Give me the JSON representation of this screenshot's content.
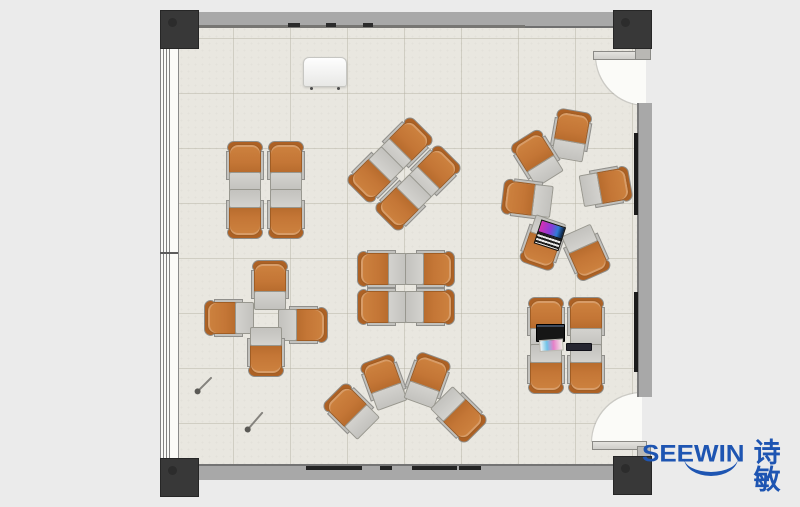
{
  "brand": {
    "name": "SEEWIN",
    "cjk": "诗敏",
    "color": "#1e55b2"
  },
  "palette": {
    "outside": "#ebebeb",
    "floor": "#e9e7e0",
    "wall": "#a8a8a8",
    "post": "#383838",
    "chair_seat": "#c47636",
    "chair_tablet": "#c9c8c4",
    "wall_board": "#1b1b1b",
    "brand_blue": "#1e55b2"
  },
  "floor_plan": {
    "chairs": [
      {
        "cluster": "quad-front-left",
        "x": 245,
        "y": 166,
        "rot": 0
      },
      {
        "cluster": "quad-front-left",
        "x": 286,
        "y": 166,
        "rot": 0
      },
      {
        "cluster": "quad-front-left",
        "x": 245,
        "y": 214,
        "rot": 180
      },
      {
        "cluster": "quad-front-left",
        "x": 286,
        "y": 214,
        "rot": 180
      },
      {
        "cluster": "quad-rotated-center",
        "x": 405,
        "y": 145,
        "rot": 45
      },
      {
        "cluster": "quad-rotated-center",
        "x": 433,
        "y": 173,
        "rot": 45
      },
      {
        "cluster": "quad-rotated-center",
        "x": 375,
        "y": 175,
        "rot": 225
      },
      {
        "cluster": "quad-rotated-center",
        "x": 403,
        "y": 203,
        "rot": 225
      },
      {
        "cluster": "circle-right",
        "x": 571,
        "y": 135,
        "rot": 10
      },
      {
        "cluster": "circle-right",
        "x": 537,
        "y": 158,
        "rot": 328
      },
      {
        "cluster": "circle-right",
        "x": 527,
        "y": 199,
        "rot": 277
      },
      {
        "cluster": "circle-right",
        "x": 543,
        "y": 243,
        "rot": 199
      },
      {
        "cluster": "circle-right",
        "x": 586,
        "y": 253,
        "rot": 156
      },
      {
        "cluster": "circle-right",
        "x": 606,
        "y": 187,
        "rot": 80
      },
      {
        "cluster": "quad-center",
        "x": 382,
        "y": 269,
        "rot": 270
      },
      {
        "cluster": "quad-center",
        "x": 382,
        "y": 307,
        "rot": 270
      },
      {
        "cluster": "quad-center",
        "x": 430,
        "y": 269,
        "rot": 90
      },
      {
        "cluster": "quad-center",
        "x": 430,
        "y": 307,
        "rot": 90
      },
      {
        "cluster": "cross-left",
        "x": 270,
        "y": 285,
        "rot": 0
      },
      {
        "cluster": "cross-left",
        "x": 229,
        "y": 318,
        "rot": 270
      },
      {
        "cluster": "cross-left",
        "x": 303,
        "y": 325,
        "rot": 90
      },
      {
        "cluster": "cross-left",
        "x": 266,
        "y": 352,
        "rot": 180
      },
      {
        "cluster": "arc-bottom",
        "x": 351,
        "y": 411,
        "rot": 315
      },
      {
        "cluster": "arc-bottom",
        "x": 384,
        "y": 382,
        "rot": 340
      },
      {
        "cluster": "arc-bottom",
        "x": 427,
        "y": 380,
        "rot": 20
      },
      {
        "cluster": "arc-bottom",
        "x": 459,
        "y": 415,
        "rot": 135
      },
      {
        "cluster": "quad-right",
        "x": 546,
        "y": 322,
        "rot": 0
      },
      {
        "cluster": "quad-right",
        "x": 586,
        "y": 322,
        "rot": 0
      },
      {
        "cluster": "quad-right",
        "x": 546,
        "y": 369,
        "rot": 180
      },
      {
        "cluster": "quad-right",
        "x": 586,
        "y": 369,
        "rot": 180
      }
    ],
    "items": [
      {
        "type": "podium",
        "name": "podium",
        "x": 303,
        "y": 57,
        "w": 42,
        "h": 28,
        "rot": 0
      },
      {
        "type": "laptop-color",
        "name": "open-laptop",
        "x": 541,
        "y": 220,
        "w": 24,
        "h": 25,
        "rot": 18
      },
      {
        "type": "laptop-black",
        "name": "closed-laptop",
        "x": 536,
        "y": 324,
        "w": 27,
        "h": 16,
        "rot": 0
      },
      {
        "type": "paper",
        "name": "color-print",
        "x": 539,
        "y": 340,
        "w": 22,
        "h": 10,
        "rot": -4
      },
      {
        "type": "notebook",
        "name": "notebook",
        "x": 566,
        "y": 343,
        "w": 24,
        "h": 6,
        "rot": 0
      },
      {
        "type": "pin",
        "name": "floor-pin",
        "x": 197,
        "y": 389,
        "w": 20,
        "h": 2,
        "rot": -45
      },
      {
        "type": "pin",
        "name": "floor-pin",
        "x": 247,
        "y": 427,
        "w": 23,
        "h": 2,
        "rot": -49
      }
    ],
    "wall_marks": {
      "top_dashes": [
        {
          "x": 288,
          "w": 12
        },
        {
          "x": 326,
          "w": 10
        },
        {
          "x": 363,
          "w": 10
        }
      ],
      "bottom_dashes": [
        {
          "x": 306,
          "w": 56
        },
        {
          "x": 380,
          "w": 12
        },
        {
          "x": 412,
          "w": 45
        },
        {
          "x": 459,
          "w": 22
        }
      ],
      "right_boards": [
        {
          "y": 133,
          "h": 82
        },
        {
          "y": 292,
          "h": 80
        }
      ]
    }
  }
}
